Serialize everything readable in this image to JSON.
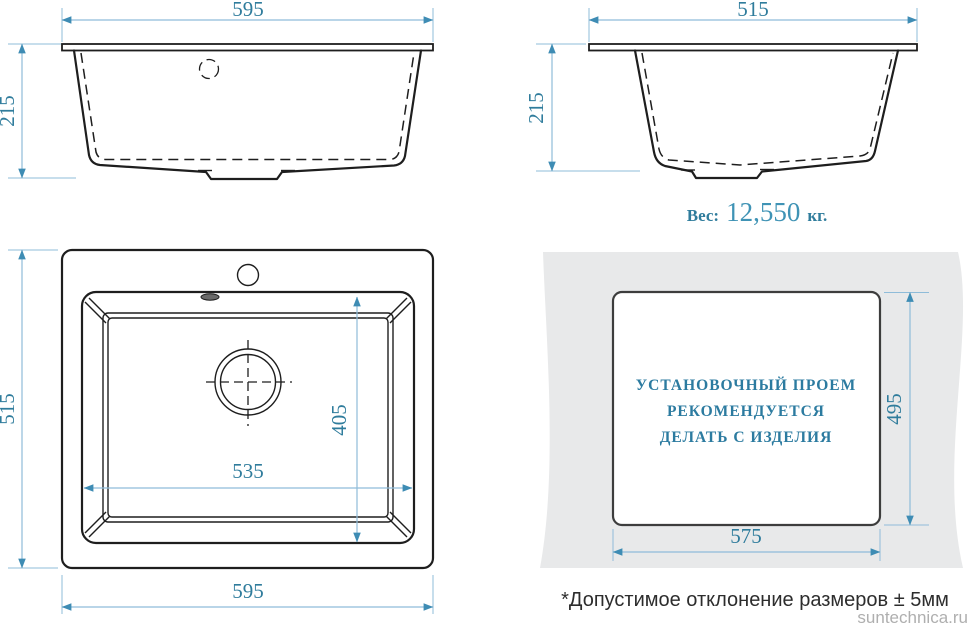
{
  "front_view": {
    "width": "595",
    "height": "215"
  },
  "side_view": {
    "width": "515",
    "height": "215",
    "weight_label": "Вес:",
    "weight_value": "12,550",
    "weight_unit": "кг."
  },
  "top_view": {
    "overall_width": "595",
    "overall_depth": "515",
    "bowl_width": "535",
    "bowl_depth": "405"
  },
  "installation": {
    "cutout_width": "575",
    "cutout_height": "495",
    "note_line1": "УСТАНОВОЧНЫЙ ПРОЕМ",
    "note_line2": "РЕКОМЕНДУЕТСЯ",
    "note_line3": "ДЕЛАТЬ С ИЗДЕЛИЯ"
  },
  "footnote": "*Допустимое отклонение размеров ± 5мм",
  "watermark": "suntechnica.ru",
  "colors": {
    "dimension_line": "#8FBCD9",
    "dimension_arrow": "#3E8CB4",
    "dimension_text": "#2F7C9C",
    "drawing_line": "#1E1E1E",
    "countertop_fill": "#E8E9EA",
    "note_text": "#2C7BA0",
    "footnote_text": "#2D2D2D",
    "watermark_text": "#AFAFAF"
  }
}
